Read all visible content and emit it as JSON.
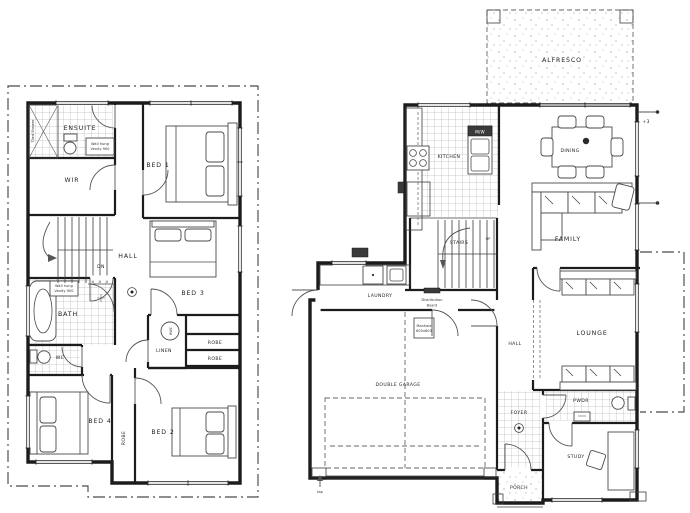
{
  "document": {
    "type": "architectural floor plan drawing, two storey house",
    "background": "#ffffff",
    "line_color": "#1c1c1c"
  },
  "upper_floor": {
    "ensuite": "ENSUITE",
    "wir": "WIR",
    "bed1": "BED 1",
    "bed2": "BED 2",
    "bed3": "BED 3",
    "bed4": "BED 4",
    "hall": "HALL",
    "dn": "DN",
    "bath": "BATH",
    "wc": "WC",
    "linen": "LINEN",
    "hwc": "HWC",
    "robe1": "ROBE",
    "robe2": "ROBE",
    "robe_bed2": "ROBE",
    "shower_note": "Tiled Shower",
    "vanity_line1": "Wall hung",
    "vanity_line2": "Vanity 900"
  },
  "ground_floor": {
    "alfresco": "ALFRESCO",
    "kitchen": "KITCHEN",
    "microwave": "M/W",
    "dining": "DINING",
    "family": "FAMILY",
    "stairs": "STAIRS",
    "up": "UP",
    "laundry": "LAUNDRY",
    "db_line1": "Distribution",
    "db_line2": "Board",
    "manhole_line1": "Manhole",
    "manhole_line2": "600x600",
    "hall": "HALL",
    "lounge": "LOUNGE",
    "garage": "DOUBLE GARAGE",
    "foyer": "FOYER",
    "pwdr": "PWDR",
    "study": "STUDY",
    "porch": "PORCH",
    "tap": "tap",
    "level": "+3"
  }
}
